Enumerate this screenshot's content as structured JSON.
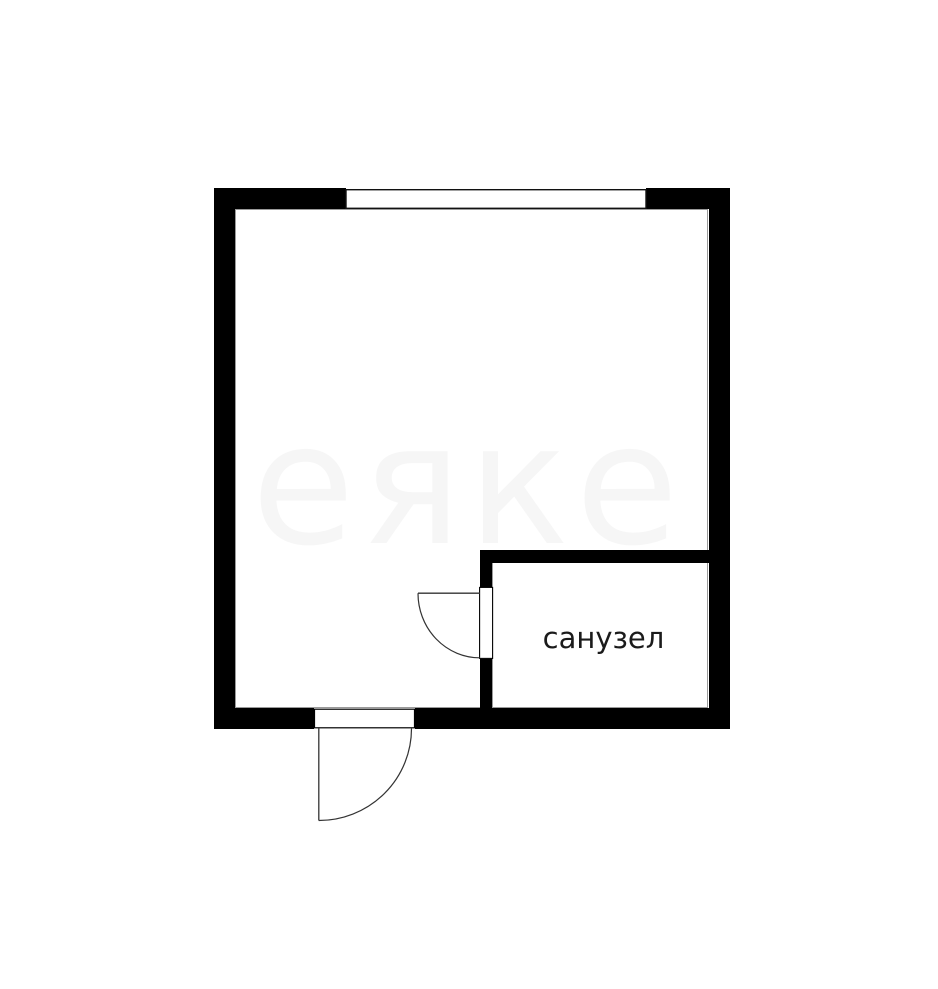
{
  "page": {
    "background_color": "#ffffff"
  },
  "floorplan": {
    "room_label": "санузел",
    "label_color": "#1b1b1b",
    "wall_color": "#000000",
    "thin_line_color": "#111111",
    "inner_outline_color": "#9a9a9a",
    "door_line_color": "#333333",
    "watermark_text": "еяке",
    "watermark_color": "#000000"
  }
}
